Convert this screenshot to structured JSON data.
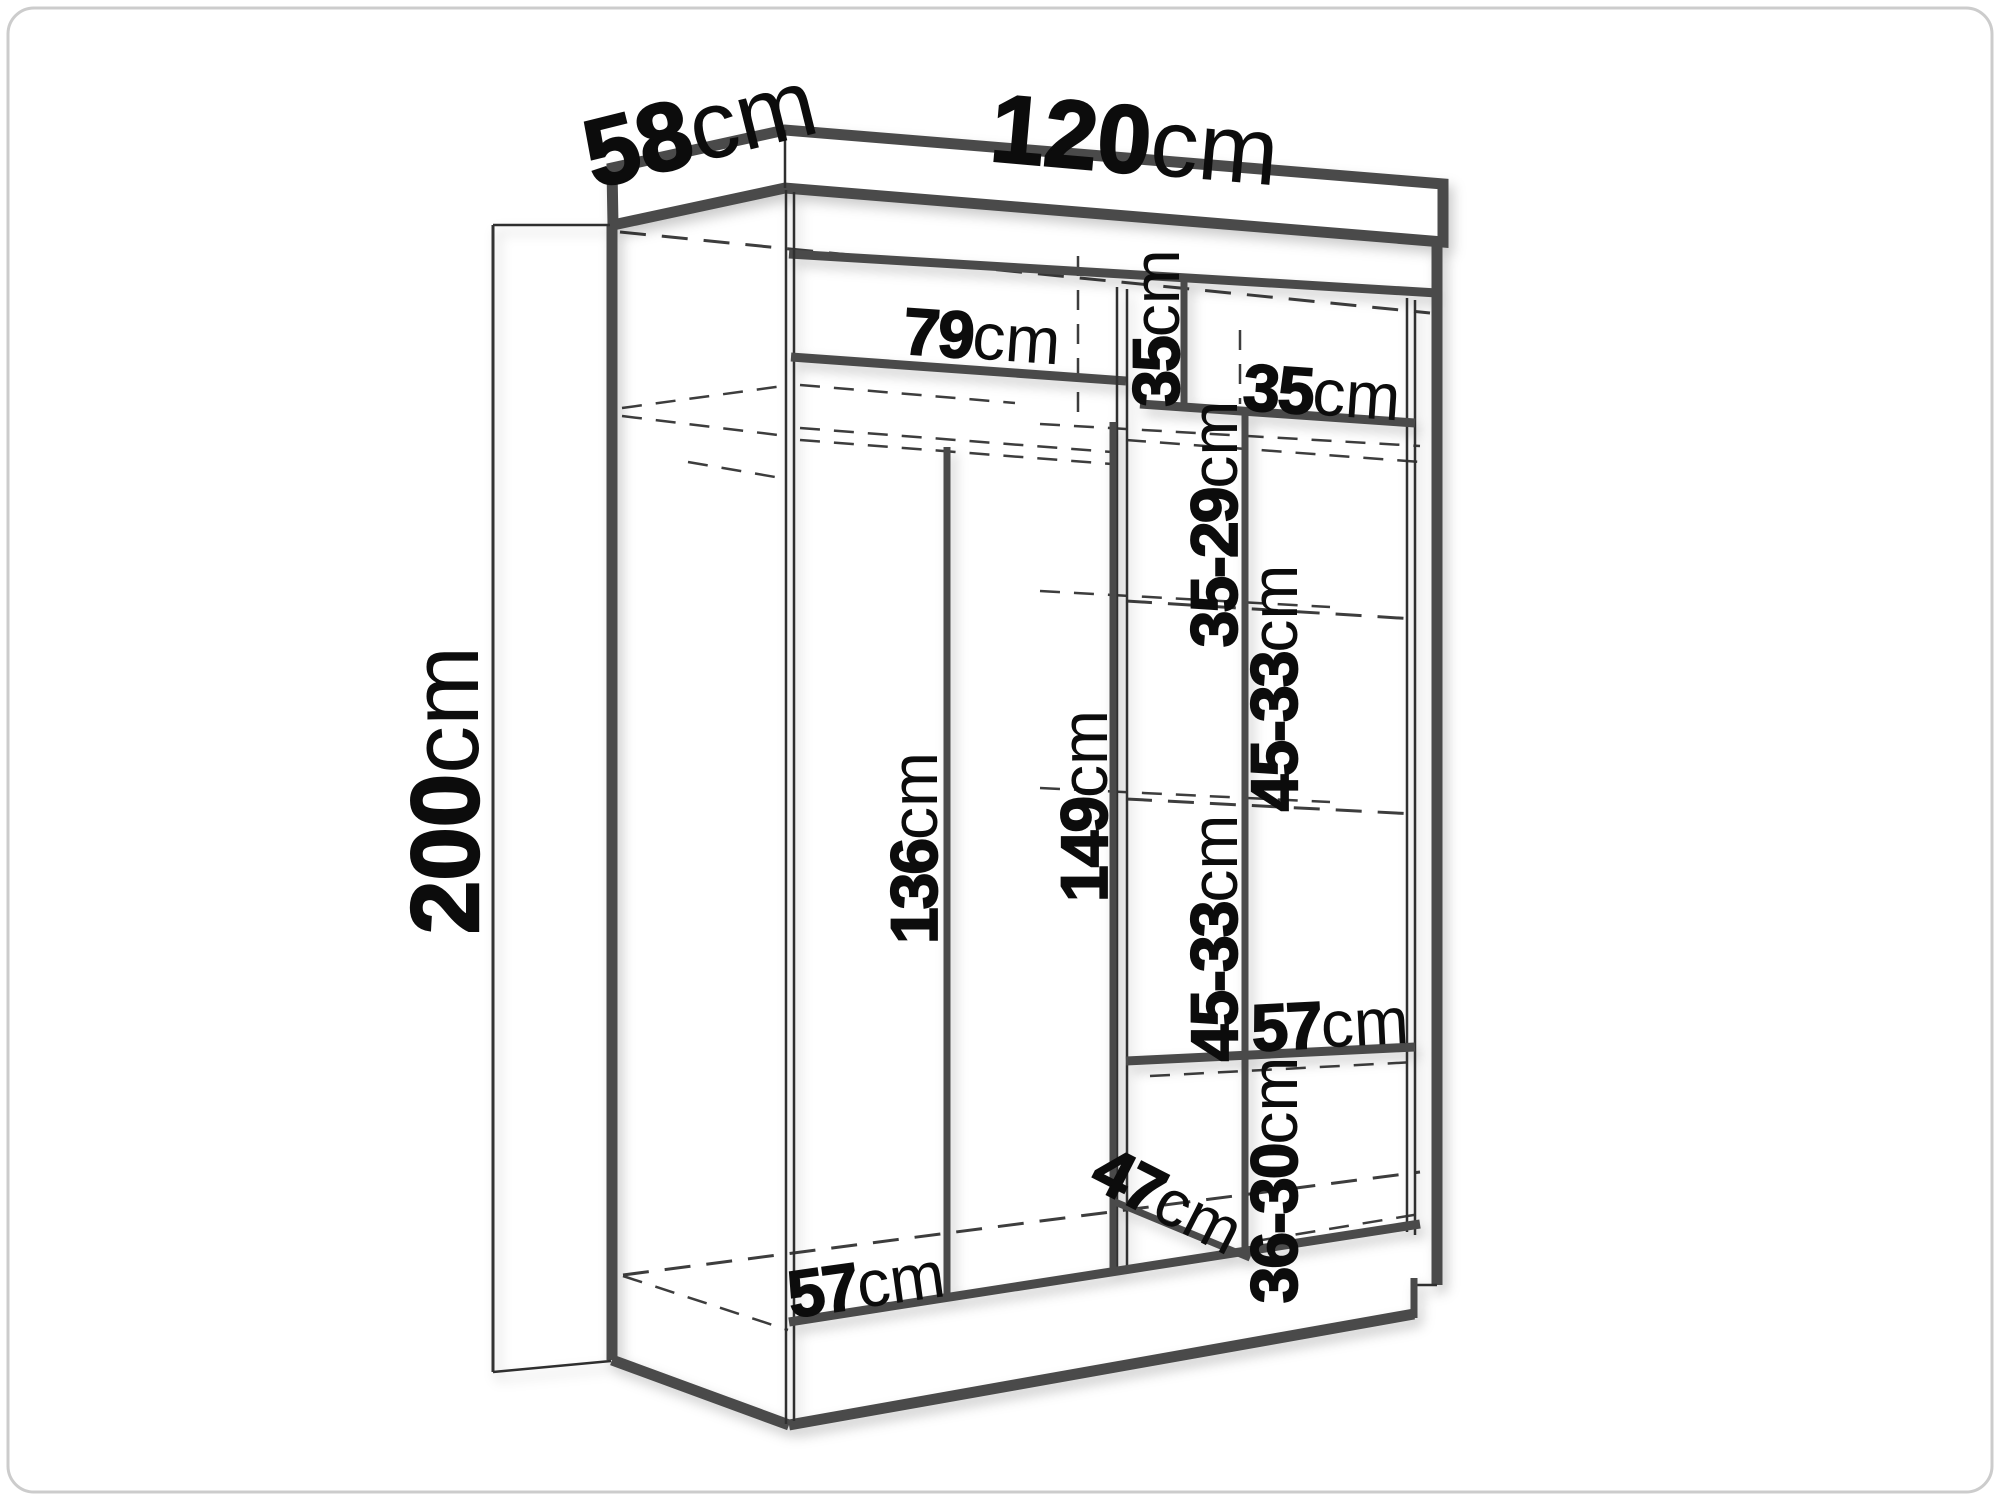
{
  "diagram": {
    "title": "Wardrobe dimension diagram",
    "type": "furniture-dimension-line-drawing",
    "unit": "cm",
    "overall": {
      "width_cm": 120,
      "depth_cm": 58,
      "height_cm": 200
    },
    "labels": {
      "depth": {
        "value": "58",
        "unit": "cm"
      },
      "width": {
        "value": "120",
        "unit": "cm"
      },
      "height": {
        "value": "200",
        "unit": "cm"
      },
      "left_shelf_width": {
        "value": "79",
        "unit": "cm"
      },
      "cubby_height": {
        "value": "35",
        "unit": "cm"
      },
      "cubby_width": {
        "value": "35",
        "unit": "cm"
      },
      "shelf_gap_top": {
        "value": "35-29",
        "unit": "cm"
      },
      "shelf_gap_upper": {
        "value": "45-33",
        "unit": "cm"
      },
      "hanging_height": {
        "value": "136",
        "unit": "cm"
      },
      "divider_height": {
        "value": "149",
        "unit": "cm"
      },
      "shelf_gap_lower": {
        "value": "45-33",
        "unit": "cm"
      },
      "shelf_depth": {
        "value": "57",
        "unit": "cm"
      },
      "shelf_gap_bottom": {
        "value": "36-30",
        "unit": "cm"
      },
      "bottom_diagonal": {
        "value": "47",
        "unit": "cm"
      },
      "floor_depth": {
        "value": "57",
        "unit": "cm"
      }
    },
    "colors": {
      "line": "#4a4a4a",
      "dash": "#3d3d3d",
      "label": "#0c0c0c",
      "frame": "#cccccc",
      "bg": "#ffffff"
    }
  }
}
